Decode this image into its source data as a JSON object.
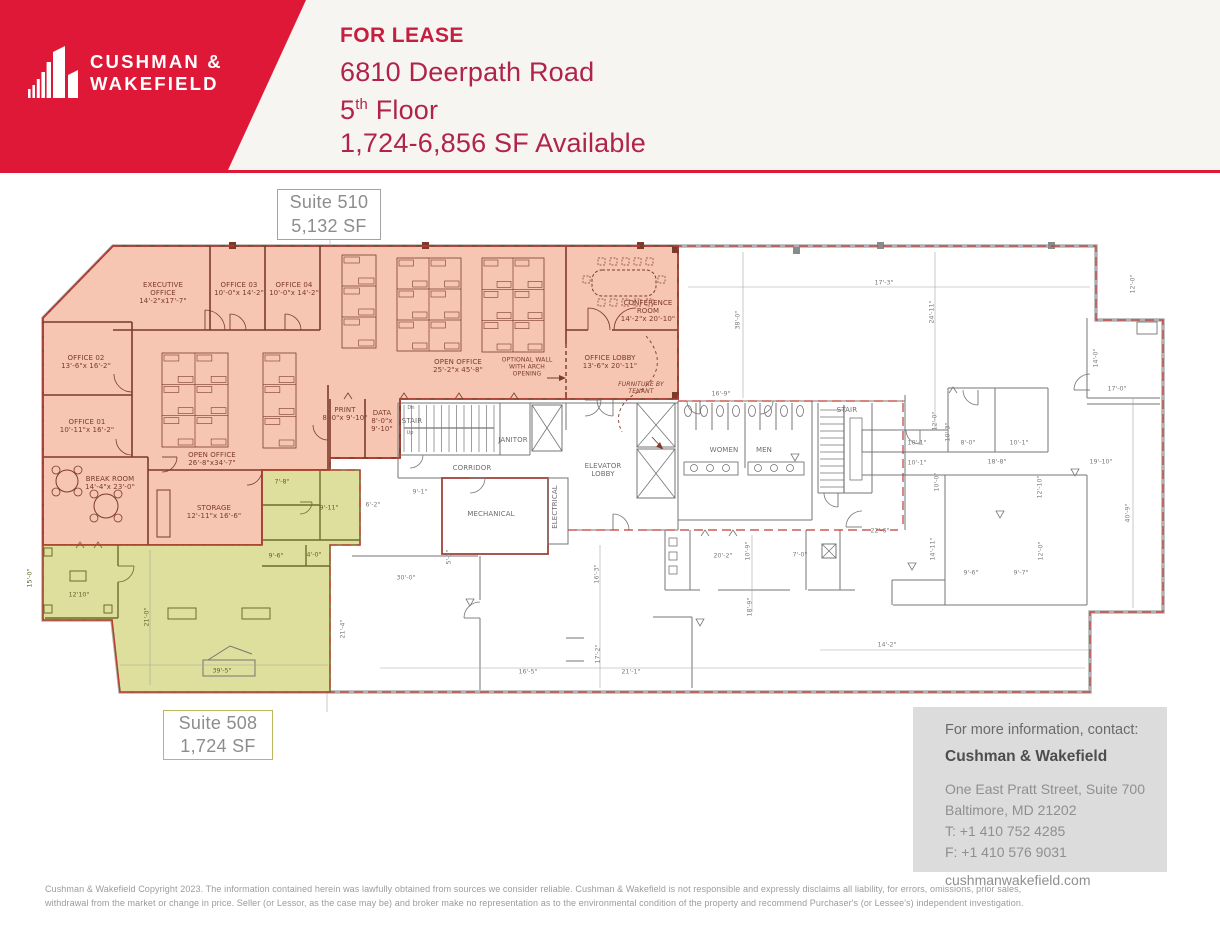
{
  "colors": {
    "brand_red": "#e01837",
    "for_lease_red": "#c51f40",
    "heading_red": "#b02449",
    "suite510_fill": "#f6c6b3",
    "suite508_fill": "#dedf9d",
    "wall_maroon": "#7c3a2a",
    "wall_olive": "#6c6c2b",
    "red_dash": "#c23a31",
    "contact_bg": "#dcdcdc"
  },
  "brand": {
    "logo_line1": "CUSHMAN &",
    "logo_line2": "WAKEFIELD"
  },
  "header": {
    "for_lease": "FOR LEASE",
    "address": "6810 Deerpath Road",
    "floor_number": "5",
    "floor_suffix": "th",
    "floor_label": " Floor",
    "availability": "1,724-6,856 SF Available"
  },
  "suites": {
    "s510": {
      "name": "Suite 510",
      "area": "5,132 SF"
    },
    "s508": {
      "name": "Suite 508",
      "area": "1,724 SF"
    }
  },
  "plan": {
    "rooms": [
      {
        "x": 163,
        "y": 293,
        "c": "m",
        "l": [
          "EXECUTIVE",
          "OFFICE",
          "14'-2\"x17'-7\""
        ]
      },
      {
        "x": 239,
        "y": 289,
        "c": "m",
        "l": [
          "OFFICE 03",
          "10'-0\"x 14'-2\""
        ]
      },
      {
        "x": 294,
        "y": 289,
        "c": "m",
        "l": [
          "OFFICE 04",
          "10'-0\"x 14'-2\""
        ]
      },
      {
        "x": 86,
        "y": 362,
        "c": "m",
        "l": [
          "OFFICE 02",
          "13'-6\"x 16'-2\""
        ]
      },
      {
        "x": 87,
        "y": 426,
        "c": "m",
        "l": [
          "OFFICE 01",
          "10'-11\"x 16'-2\""
        ]
      },
      {
        "x": 110,
        "y": 483,
        "c": "m",
        "l": [
          "BREAK ROOM",
          "14'-4\"x 23'-0\""
        ]
      },
      {
        "x": 212,
        "y": 459,
        "c": "m",
        "l": [
          "OPEN OFFICE",
          "26'-8\"x34'-7\""
        ]
      },
      {
        "x": 214,
        "y": 512,
        "c": "m",
        "l": [
          "STORAGE",
          "12'-11\"x 16'-6\""
        ]
      },
      {
        "x": 458,
        "y": 366,
        "c": "m",
        "l": [
          "OPEN OFFICE",
          "25'-2\"x 45'-8\""
        ]
      },
      {
        "x": 527,
        "y": 367,
        "c": "m sm",
        "l": [
          "OPTIONAL  WALL",
          "WITH  ARCH",
          "OPENING"
        ]
      },
      {
        "x": 648,
        "y": 311,
        "c": "m",
        "l": [
          "CONFERENCE",
          "ROOM",
          "14'-2\"x 20'-10\""
        ]
      },
      {
        "x": 610,
        "y": 362,
        "c": "m",
        "l": [
          "OFFICE LOBBY",
          "13'-6\"x 20'-11\""
        ]
      },
      {
        "x": 641,
        "y": 388,
        "c": "m it sm",
        "l": [
          "FURNITURE  BY",
          "TENANT"
        ]
      },
      {
        "x": 345,
        "y": 414,
        "c": "m",
        "l": [
          "PRINT",
          "8'-0\"x 9'-10\""
        ]
      },
      {
        "x": 382,
        "y": 421,
        "c": "m",
        "l": [
          "DATA",
          "8'-0\"x",
          "9'-10\""
        ]
      },
      {
        "x": 412,
        "y": 421,
        "c": "g",
        "l": [
          "STAIR"
        ]
      },
      {
        "x": 411,
        "y": 409,
        "c": "g tiny",
        "l": [
          "Dn"
        ]
      },
      {
        "x": 410,
        "y": 434,
        "c": "g tiny",
        "l": [
          "Up"
        ]
      },
      {
        "x": 513,
        "y": 440,
        "c": "g",
        "l": [
          "JANITOR"
        ]
      },
      {
        "x": 472,
        "y": 468,
        "c": "g",
        "l": [
          "CORRIDOR"
        ]
      },
      {
        "x": 491,
        "y": 514,
        "c": "g",
        "l": [
          "MECHANICAL"
        ]
      },
      {
        "x": 555,
        "y": 507,
        "r": -90,
        "c": "g",
        "l": [
          "ELECTRICAL"
        ]
      },
      {
        "x": 603,
        "y": 470,
        "c": "g",
        "l": [
          "ELEVATOR",
          "LOBBY"
        ]
      },
      {
        "x": 724,
        "y": 450,
        "c": "g",
        "l": [
          "WOMEN"
        ]
      },
      {
        "x": 764,
        "y": 450,
        "c": "g",
        "l": [
          "MEN"
        ]
      },
      {
        "x": 847,
        "y": 410,
        "c": "g",
        "l": [
          "STAIR"
        ]
      }
    ],
    "dims": [
      {
        "x": 30,
        "y": 578,
        "r": -90,
        "c": "o",
        "v": "15'-0\""
      },
      {
        "x": 79,
        "y": 595,
        "r": 0,
        "c": "o",
        "v": "12'10\""
      },
      {
        "x": 147,
        "y": 617,
        "r": -90,
        "c": "o",
        "v": "21'-0\""
      },
      {
        "x": 222,
        "y": 671,
        "r": 0,
        "c": "o",
        "v": "39'-5\""
      },
      {
        "x": 282,
        "y": 482,
        "r": 0,
        "c": "o",
        "v": "7'-8\""
      },
      {
        "x": 329,
        "y": 508,
        "r": 0,
        "c": "o",
        "v": "9'-11\""
      },
      {
        "x": 276,
        "y": 556,
        "r": 0,
        "c": "o",
        "v": "9'-6\""
      },
      {
        "x": 314,
        "y": 555,
        "r": 0,
        "c": "o",
        "v": "4'-0\""
      },
      {
        "x": 373,
        "y": 505,
        "r": 0,
        "c": "g",
        "v": "6'-2\""
      },
      {
        "x": 420,
        "y": 492,
        "r": 0,
        "c": "g",
        "v": "9'-1\""
      },
      {
        "x": 406,
        "y": 578,
        "r": 0,
        "c": "g",
        "v": "30'-0\""
      },
      {
        "x": 449,
        "y": 557,
        "r": -90,
        "c": "g",
        "v": "5'-1\""
      },
      {
        "x": 343,
        "y": 629,
        "r": -90,
        "c": "g",
        "v": "21'-4\""
      },
      {
        "x": 597,
        "y": 574,
        "r": -90,
        "c": "g",
        "v": "16'-3\""
      },
      {
        "x": 598,
        "y": 654,
        "r": -90,
        "c": "g",
        "v": "17'-2\""
      },
      {
        "x": 528,
        "y": 672,
        "r": 0,
        "c": "g",
        "v": "16'-5\""
      },
      {
        "x": 631,
        "y": 672,
        "r": 0,
        "c": "g",
        "v": "21'-1\""
      },
      {
        "x": 887,
        "y": 645,
        "r": 0,
        "c": "g",
        "v": "14'-2\""
      },
      {
        "x": 721,
        "y": 394,
        "r": 0,
        "c": "g",
        "v": "16'-9\""
      },
      {
        "x": 723,
        "y": 556,
        "r": 0,
        "c": "g",
        "v": "20'-2\""
      },
      {
        "x": 748,
        "y": 551,
        "r": -90,
        "c": "g",
        "v": "10'-9\""
      },
      {
        "x": 800,
        "y": 555,
        "r": 0,
        "c": "g",
        "v": "7'-0\""
      },
      {
        "x": 750,
        "y": 607,
        "r": -90,
        "c": "g",
        "v": "18'-9\""
      },
      {
        "x": 880,
        "y": 531,
        "r": 0,
        "c": "g",
        "v": "22'-6\""
      },
      {
        "x": 933,
        "y": 549,
        "r": -90,
        "c": "g",
        "v": "14'-11\""
      },
      {
        "x": 1041,
        "y": 551,
        "r": -90,
        "c": "g",
        "v": "12'-0\""
      },
      {
        "x": 971,
        "y": 573,
        "r": 0,
        "c": "g",
        "v": "9'-6\""
      },
      {
        "x": 1021,
        "y": 573,
        "r": 0,
        "c": "g",
        "v": "9'-7\""
      },
      {
        "x": 1128,
        "y": 513,
        "r": -90,
        "c": "g",
        "v": "40'-9\""
      },
      {
        "x": 917,
        "y": 443,
        "r": 0,
        "c": "g",
        "v": "10'-1\""
      },
      {
        "x": 968,
        "y": 443,
        "r": 0,
        "c": "g",
        "v": "8'-0\""
      },
      {
        "x": 1019,
        "y": 443,
        "r": 0,
        "c": "g",
        "v": "10'-1\""
      },
      {
        "x": 917,
        "y": 463,
        "r": 0,
        "c": "g",
        "v": "10'-1\""
      },
      {
        "x": 997,
        "y": 462,
        "r": 0,
        "c": "g",
        "v": "18'-8\""
      },
      {
        "x": 1101,
        "y": 462,
        "r": 0,
        "c": "g",
        "v": "19'-10\""
      },
      {
        "x": 937,
        "y": 482,
        "r": -90,
        "c": "g",
        "v": "10'-0\""
      },
      {
        "x": 1040,
        "y": 487,
        "r": -90,
        "c": "g",
        "v": "12'-10\""
      },
      {
        "x": 884,
        "y": 283,
        "r": 0,
        "c": "g",
        "v": "17'-3\""
      },
      {
        "x": 932,
        "y": 312,
        "r": -90,
        "c": "g",
        "v": "24'-11\""
      },
      {
        "x": 935,
        "y": 421,
        "r": -90,
        "c": "g",
        "v": "12'-0\""
      },
      {
        "x": 948,
        "y": 432,
        "r": -90,
        "c": "g",
        "v": "10'-3\""
      },
      {
        "x": 1096,
        "y": 358,
        "r": -90,
        "c": "g",
        "v": "14'-0\""
      },
      {
        "x": 1117,
        "y": 389,
        "r": 0,
        "c": "g",
        "v": "17'-0\""
      },
      {
        "x": 1133,
        "y": 284,
        "r": -90,
        "c": "g",
        "v": "12'-0\""
      },
      {
        "x": 738,
        "y": 320,
        "r": -90,
        "c": "g",
        "v": "38'-0\""
      }
    ]
  },
  "contact": {
    "heading": "For more information, contact:",
    "name": "Cushman & Wakefield",
    "address1": "One East Pratt Street, Suite 700",
    "address2": "Baltimore, MD 21202",
    "phone": "T: +1 410 752 4285",
    "fax": "F: +1 410 576 9031",
    "website": "cushmanwakefield.com"
  },
  "disclaimer": {
    "line1": "Cushman & Wakefield Copyright 2023. The information contained herein was lawfully obtained from sources we consider reliable. Cushman & Wakefield is not responsible and expressly disclaims all liability, for errors, omissions, prior sales,",
    "line2": "withdrawal from the market or change in price. Seller (or Lessor, as the case may be) and broker make no representation as to the environmental condition of the property and recommend Purchaser's (or Lessee's) independent investigation."
  }
}
